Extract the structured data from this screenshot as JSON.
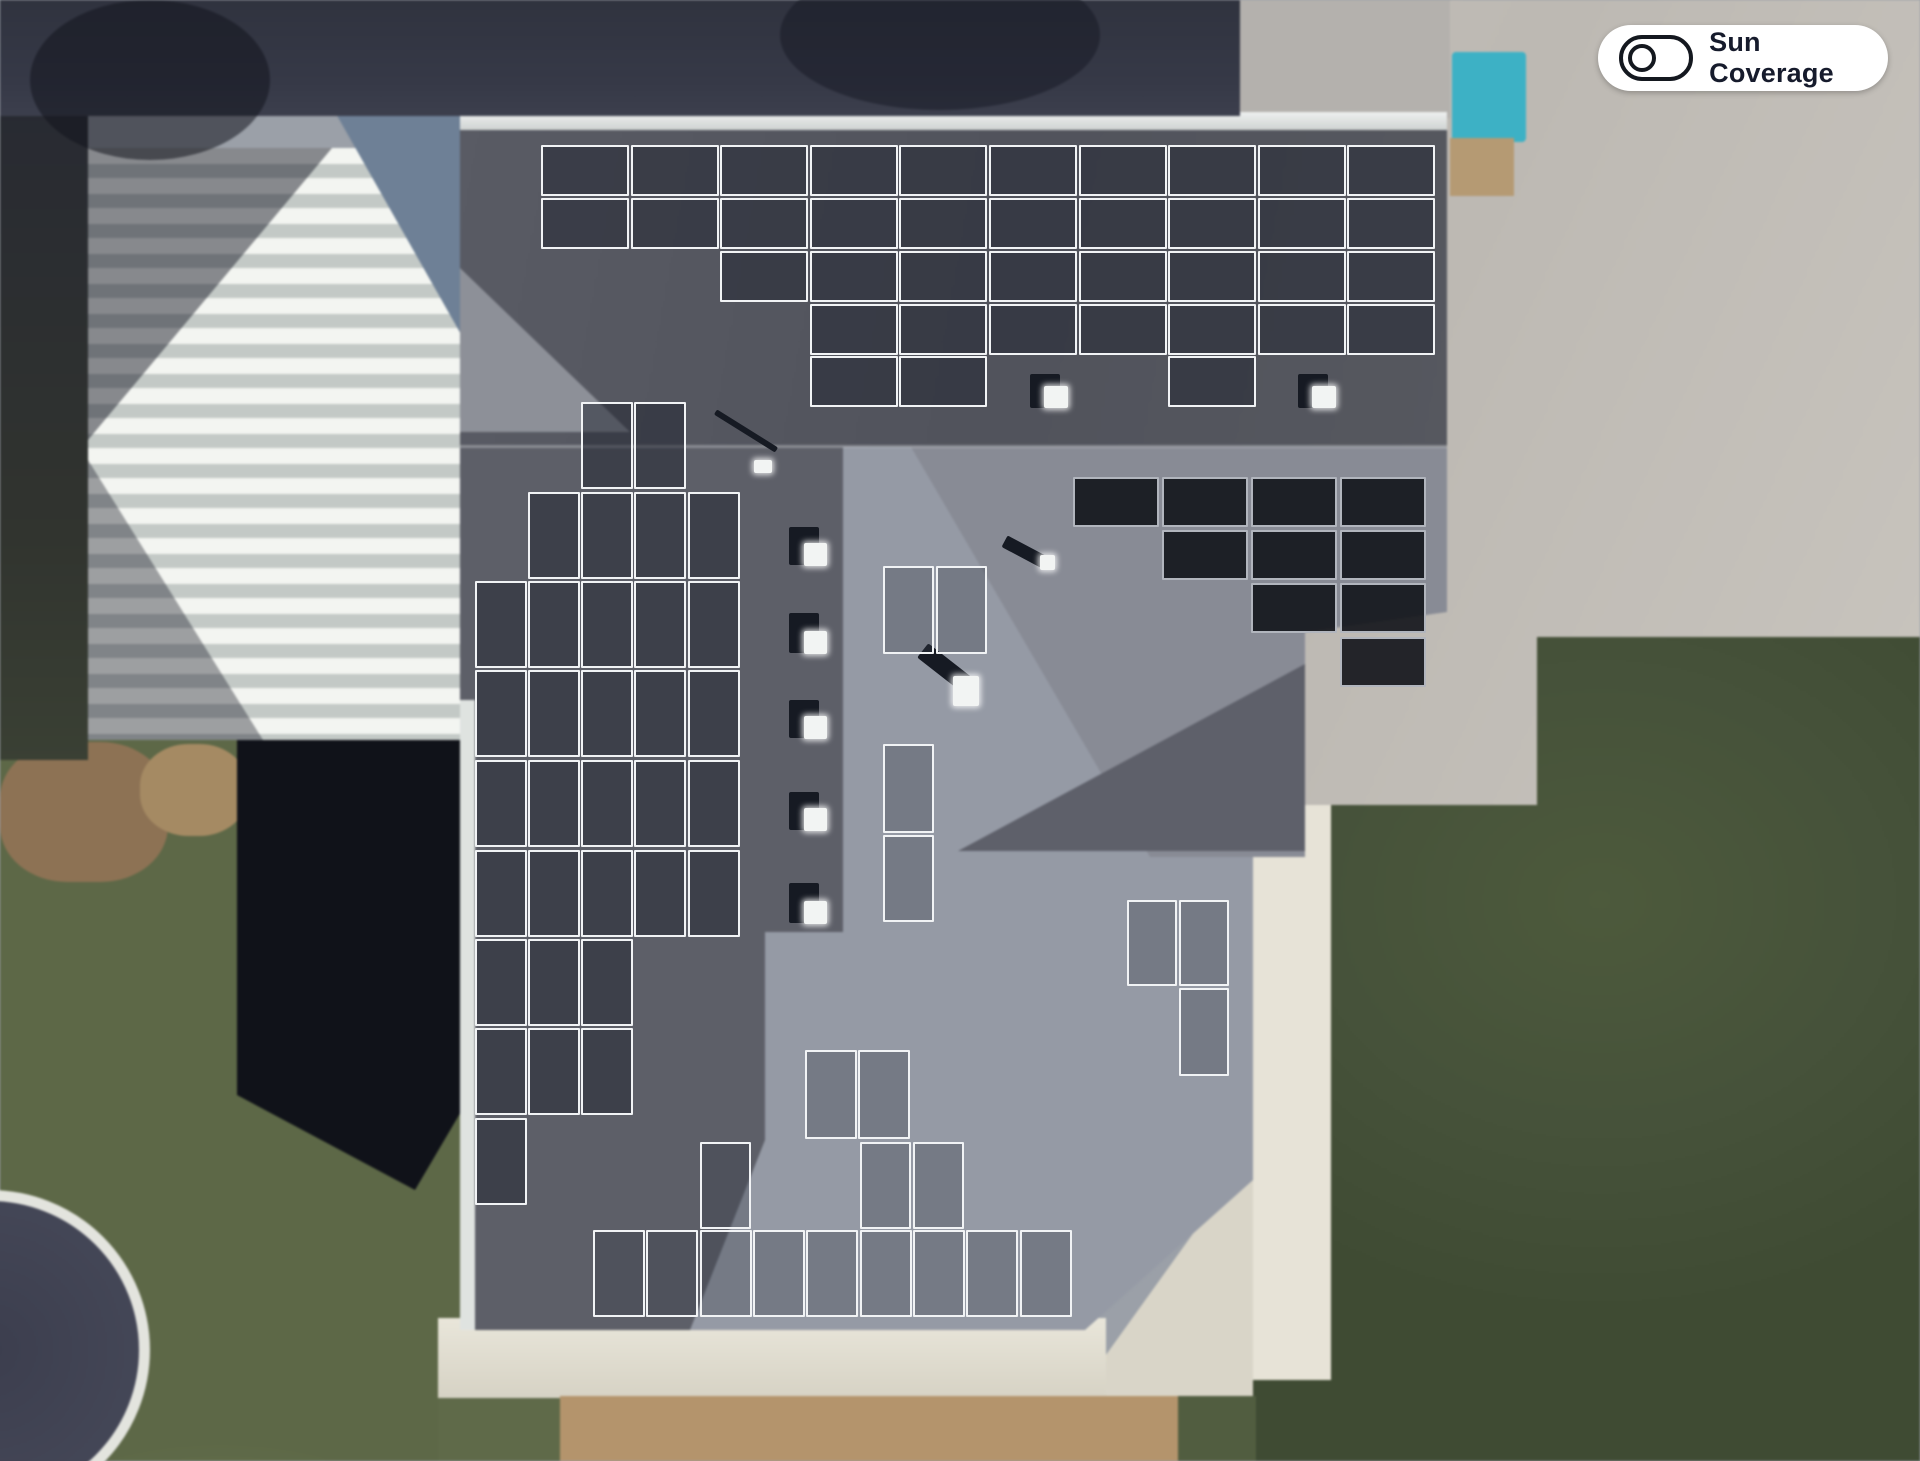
{
  "toolbar": {
    "sun_coverage_label": "Sun Coverage",
    "sun_coverage_state": "off"
  },
  "palette": {
    "panel_border": "#f1f3f5",
    "panel_fill_dark_roof": "rgba(33,37,47,0.52)",
    "panel_fill_light_roof": "rgba(52,57,70,0.33)",
    "panel_fill_black": "rgba(18,20,26,0.9)",
    "roof_dark_face": "#54565f",
    "roof_light_face": "#959aa5",
    "grass_left": "#68734f",
    "grass_right": "#46523a",
    "concrete": "#c7c3bc",
    "pool_teal": "#3db1c5",
    "toggle_ink": "#14181f"
  },
  "scene": {
    "description": "aerial satellite view of a hip-roof house with a solar panel layout overlay",
    "panel_total": 102,
    "panel_groups": [
      {
        "id": "top-array",
        "style": "dark",
        "w": 88,
        "h": 51,
        "panels": [
          [
            541,
            145
          ],
          [
            631,
            145
          ],
          [
            720,
            145
          ],
          [
            810,
            145
          ],
          [
            899,
            145
          ],
          [
            989,
            145
          ],
          [
            1079,
            145
          ],
          [
            1168,
            145
          ],
          [
            1258,
            145
          ],
          [
            1347,
            145
          ],
          [
            541,
            198
          ],
          [
            631,
            198
          ],
          [
            720,
            198
          ],
          [
            810,
            198
          ],
          [
            899,
            198
          ],
          [
            989,
            198
          ],
          [
            1079,
            198
          ],
          [
            1168,
            198
          ],
          [
            1258,
            198
          ],
          [
            1347,
            198
          ],
          [
            720,
            251
          ],
          [
            810,
            251
          ],
          [
            899,
            251
          ],
          [
            989,
            251
          ],
          [
            1079,
            251
          ],
          [
            1168,
            251
          ],
          [
            1258,
            251
          ],
          [
            1347,
            251
          ],
          [
            810,
            304
          ],
          [
            899,
            304
          ],
          [
            989,
            304
          ],
          [
            1079,
            304
          ],
          [
            1168,
            304
          ],
          [
            1258,
            304
          ],
          [
            1347,
            304
          ],
          [
            810,
            356
          ],
          [
            899,
            356
          ],
          [
            1168,
            356
          ]
        ]
      },
      {
        "id": "left-array",
        "style": "dark",
        "w": 52,
        "h": 87,
        "panels": [
          [
            581,
            402
          ],
          [
            634,
            402
          ],
          [
            528,
            492
          ],
          [
            581,
            492
          ],
          [
            634,
            492
          ],
          [
            688,
            492
          ],
          [
            475,
            581
          ],
          [
            528,
            581
          ],
          [
            581,
            581
          ],
          [
            634,
            581
          ],
          [
            688,
            581
          ],
          [
            475,
            670
          ],
          [
            528,
            670
          ],
          [
            581,
            670
          ],
          [
            634,
            670
          ],
          [
            688,
            670
          ],
          [
            475,
            760
          ],
          [
            528,
            760
          ],
          [
            581,
            760
          ],
          [
            634,
            760
          ],
          [
            688,
            760
          ],
          [
            475,
            850
          ],
          [
            528,
            850
          ],
          [
            581,
            850
          ],
          [
            634,
            850
          ],
          [
            688,
            850
          ],
          [
            475,
            939
          ],
          [
            528,
            939
          ],
          [
            581,
            939
          ],
          [
            475,
            1028
          ],
          [
            528,
            1028
          ],
          [
            581,
            1028
          ],
          [
            475,
            1118
          ]
        ]
      },
      {
        "id": "right-dark-array",
        "style": "black",
        "w": 86,
        "h": 50,
        "panels": [
          [
            1073,
            477
          ],
          [
            1162,
            477
          ],
          [
            1251,
            477
          ],
          [
            1340,
            477
          ],
          [
            1162,
            530
          ],
          [
            1251,
            530
          ],
          [
            1340,
            530
          ],
          [
            1251,
            583
          ],
          [
            1340,
            583
          ],
          [
            1340,
            637
          ]
        ]
      },
      {
        "id": "center-pair",
        "style": "light",
        "w": 51,
        "h": 88,
        "panels": [
          [
            883,
            566
          ],
          [
            936,
            566
          ]
        ]
      },
      {
        "id": "center-stack",
        "style": "light",
        "w": 51,
        "h": 89,
        "panels": [
          [
            883,
            744
          ],
          [
            883,
            835,
            51,
            87
          ]
        ]
      },
      {
        "id": "mid-right-group",
        "style": "light",
        "w": 50,
        "h": 86,
        "panels": [
          [
            1127,
            900
          ],
          [
            1179,
            900
          ],
          [
            1179,
            988,
            50,
            88
          ]
        ]
      },
      {
        "id": "bottom-pair",
        "style": "light",
        "w": 52,
        "h": 89,
        "panels": [
          [
            805,
            1050
          ],
          [
            858,
            1050
          ]
        ]
      },
      {
        "id": "bottom-mid-row",
        "style": "light",
        "w": 51,
        "h": 87,
        "panels": [
          [
            700,
            1142
          ],
          [
            860,
            1142
          ],
          [
            913,
            1142
          ]
        ]
      },
      {
        "id": "bottom-row",
        "style": "light",
        "w": 52,
        "h": 87,
        "panels": [
          [
            593,
            1230
          ],
          [
            646,
            1230
          ],
          [
            700,
            1230
          ],
          [
            753,
            1230
          ],
          [
            806,
            1230
          ],
          [
            860,
            1230
          ],
          [
            913,
            1230
          ],
          [
            966,
            1230
          ],
          [
            1020,
            1230
          ]
        ]
      }
    ],
    "vents": [
      {
        "x": 1030,
        "y": 374,
        "w": 30,
        "h": 34,
        "rot": 0,
        "glow": {
          "dx": 14,
          "dy": 12,
          "w": 24,
          "h": 22
        }
      },
      {
        "x": 1298,
        "y": 374,
        "w": 30,
        "h": 34,
        "rot": 0,
        "glow": {
          "dx": 14,
          "dy": 12,
          "w": 24,
          "h": 22
        }
      },
      {
        "x": 789,
        "y": 527,
        "w": 30,
        "h": 38,
        "rot": 0,
        "glow": {
          "dx": 15,
          "dy": 16,
          "w": 23,
          "h": 23
        }
      },
      {
        "x": 789,
        "y": 613,
        "w": 30,
        "h": 40,
        "rot": 0,
        "glow": {
          "dx": 15,
          "dy": 18,
          "w": 23,
          "h": 23
        }
      },
      {
        "x": 789,
        "y": 700,
        "w": 30,
        "h": 38,
        "rot": 0,
        "glow": {
          "dx": 15,
          "dy": 16,
          "w": 23,
          "h": 23
        }
      },
      {
        "x": 789,
        "y": 792,
        "w": 30,
        "h": 38,
        "rot": 0,
        "glow": {
          "dx": 15,
          "dy": 16,
          "w": 23,
          "h": 23
        }
      },
      {
        "x": 789,
        "y": 883,
        "w": 30,
        "h": 40,
        "rot": 0,
        "glow": {
          "dx": 15,
          "dy": 18,
          "w": 23,
          "h": 23
        }
      },
      {
        "x": 917,
        "y": 658,
        "w": 54,
        "h": 18,
        "rot": 38,
        "glow": {
          "dx": 36,
          "dy": 18,
          "w": 26,
          "h": 30
        }
      },
      {
        "x": 1002,
        "y": 545,
        "w": 44,
        "h": 13,
        "rot": 28,
        "glow": {
          "dx": 38,
          "dy": 10,
          "w": 15,
          "h": 15
        }
      },
      {
        "x": 710,
        "y": 428,
        "w": 72,
        "h": 6,
        "rot": 32,
        "glow": {
          "dx": 44,
          "dy": 32,
          "w": 18,
          "h": 13
        }
      }
    ]
  }
}
